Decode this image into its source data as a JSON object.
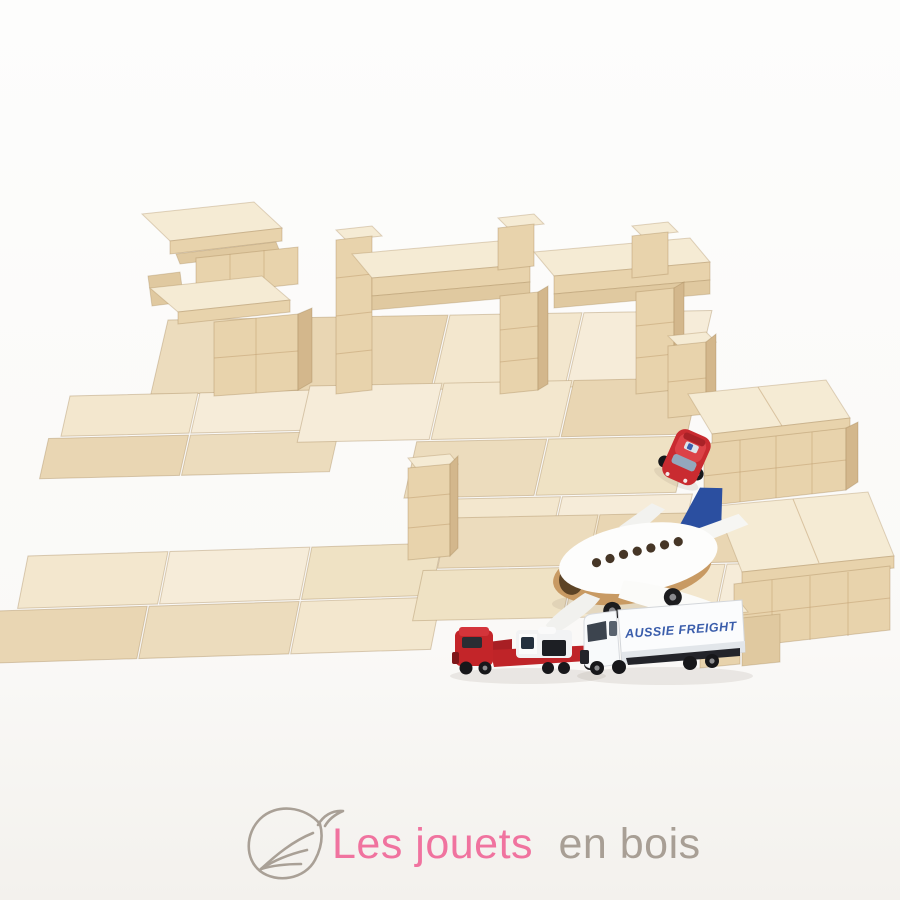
{
  "scene": {
    "description": "Natural wooden building blocks arranged as an airport scene with toy vehicles on a white studio background",
    "background_top": "#fdfdfc",
    "background_bottom": "#f3f1ed"
  },
  "palette": {
    "wood_top_bright": "#f6ecd9",
    "wood_top": "#f1e4c8",
    "wood_mid": "#ead9b8",
    "wood_front": "#e7d2ac",
    "wood_side": "#d3b78c",
    "wood_deep": "#c5a77a",
    "seam": "#c9ac80"
  },
  "vehicles": {
    "airplane": {
      "body_color": "#fdfdfc",
      "tail_color": "#2b4fa0",
      "belly_color": "#c89a63"
    },
    "freight_truck": {
      "label": "AUSSIE FREIGHT",
      "label_color": "#3a5dab",
      "body_color": "#fbfcfd"
    },
    "flatbed_truck": {
      "body_color": "#c02428"
    },
    "red_car": {
      "body_color": "#cc2a30"
    }
  },
  "logo": {
    "text_primary": "Les jouets",
    "text_secondary": "en bois",
    "color_primary": "#f0739f",
    "color_secondary": "#a89f95",
    "icon": "leaf-icon",
    "icon_color": "#a9a096"
  }
}
